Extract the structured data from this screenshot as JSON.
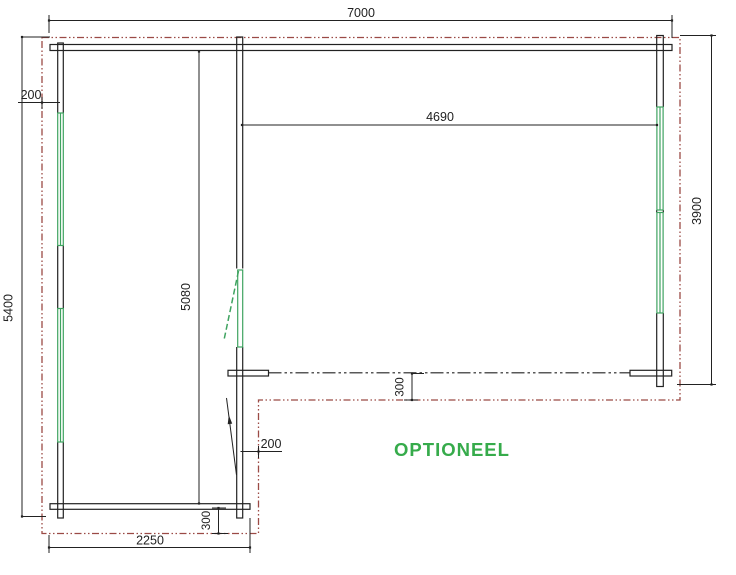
{
  "drawing": {
    "type": "floor-plan",
    "note_label": "OPTIONEEL",
    "dimensions": {
      "overall_width": "7000",
      "interior_width": "4690",
      "right_side_depth": "3900",
      "left_side_depth": "5400",
      "interior_depth": "5080",
      "annex_width": "2250",
      "overhang_top_left": "200",
      "overhang_door_side": "200",
      "overhang_veranda_front": "300",
      "overhang_annex_bottom": "300"
    },
    "colors": {
      "ink": "#222222",
      "roof_outline_red": "#9b4a45",
      "window_green": "#3fa360",
      "note_green": "#36ab4b",
      "background": "#ffffff"
    }
  }
}
